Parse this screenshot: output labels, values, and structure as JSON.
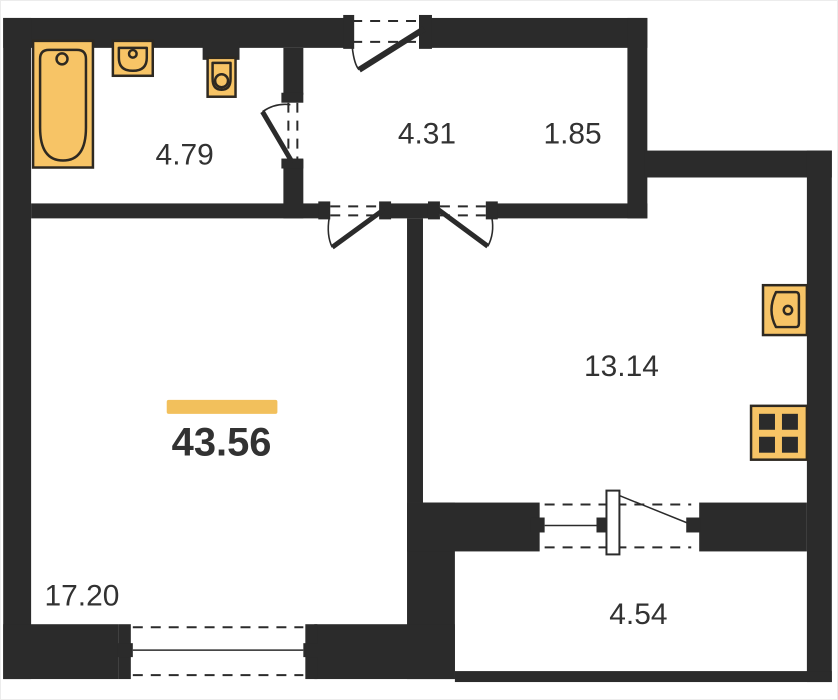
{
  "plan": {
    "total": {
      "area": "43.56"
    },
    "rooms": [
      {
        "key": "bathroom",
        "area": "4.79"
      },
      {
        "key": "hallway",
        "area": "4.31"
      },
      {
        "key": "storage",
        "area": "1.85"
      },
      {
        "key": "kitchen",
        "area": "13.14"
      },
      {
        "key": "living_room",
        "area": "17.20"
      },
      {
        "key": "balcony",
        "area": "4.54"
      }
    ],
    "fixtures": [
      "bathtub-icon",
      "bathroom-sink-icon",
      "toilet-icon",
      "kitchen-sink-icon",
      "stove-icon"
    ],
    "colors": {
      "wall": "#2b2b2b",
      "fixture_fill": "#f7c466",
      "fixture_outline": "#2e2921",
      "accent_bar": "#f2c05c",
      "label_text": "#323232"
    }
  }
}
